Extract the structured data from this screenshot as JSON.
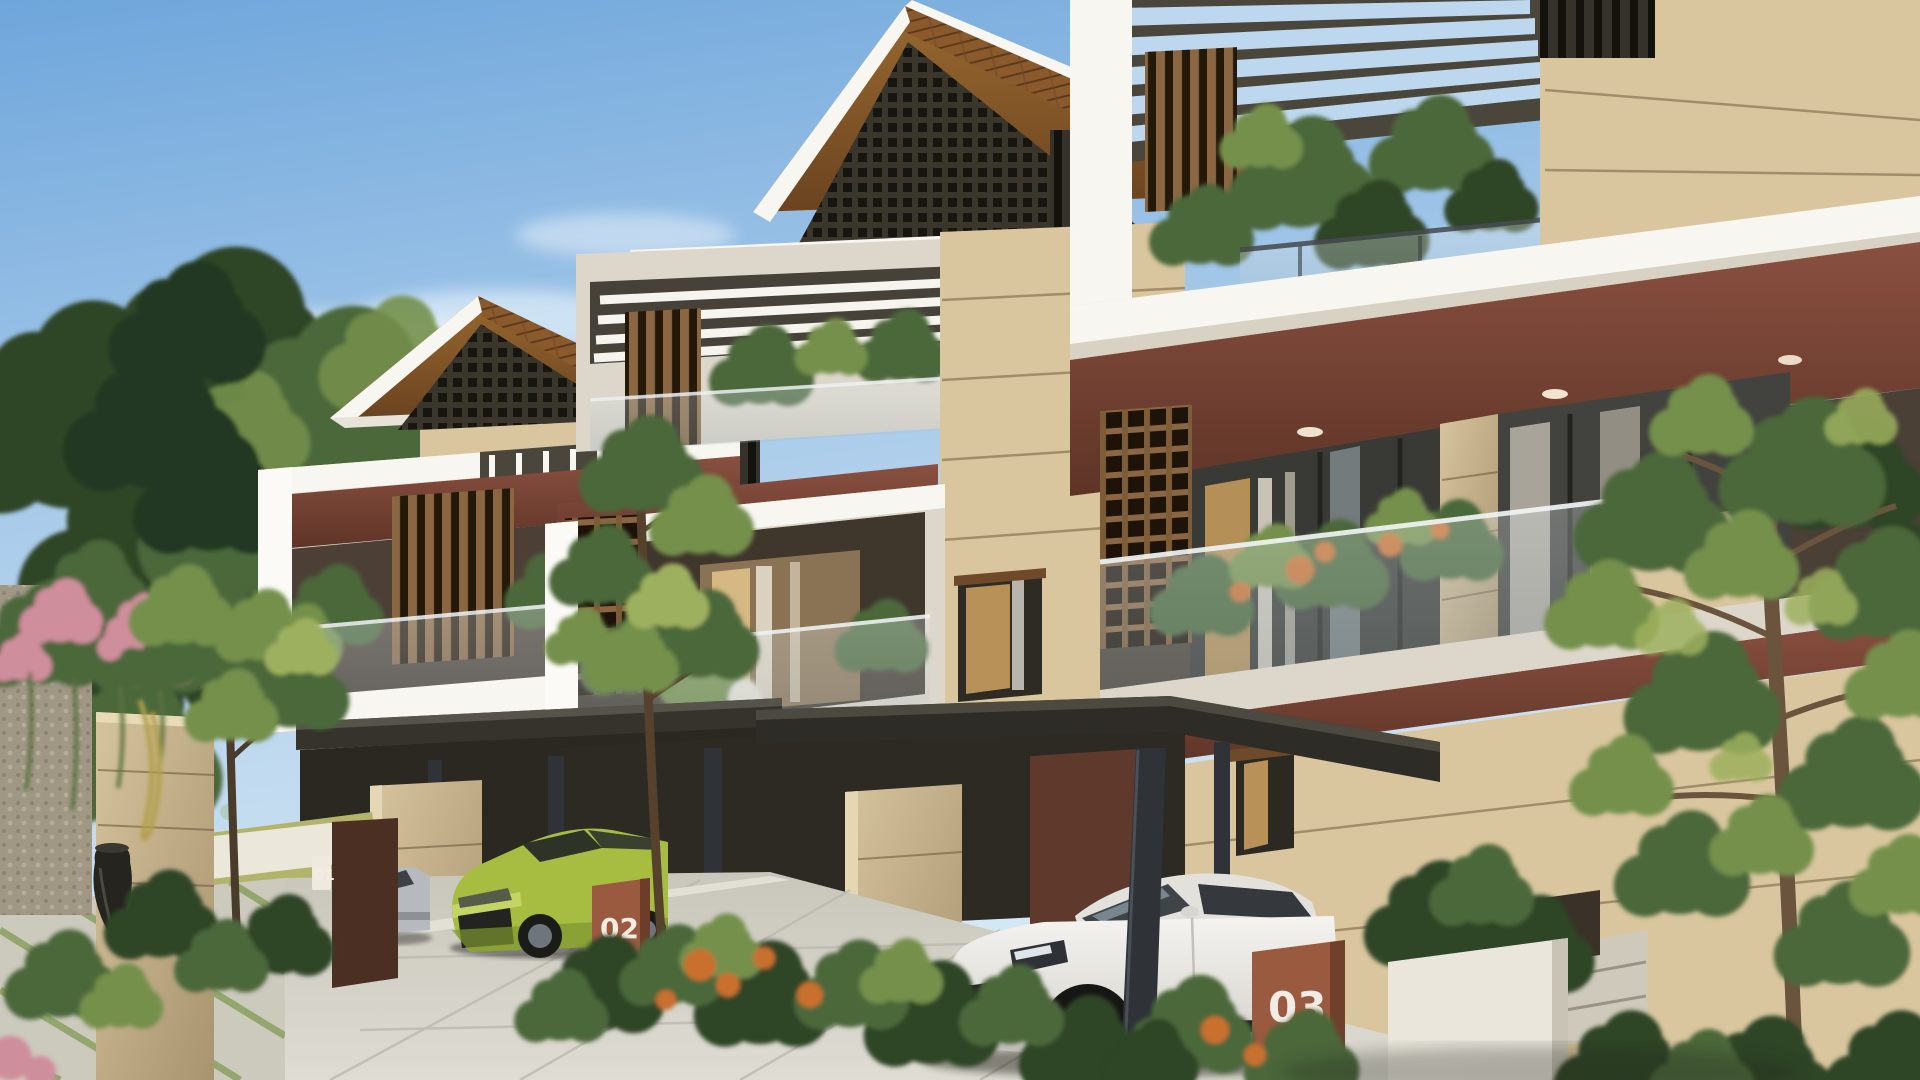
{
  "scene": {
    "markers": {
      "unit01": "01",
      "unit02": "02",
      "unit03": "03"
    }
  },
  "palette": {
    "sky_top": "#74a9dc",
    "sky_low": "#d7e8f5",
    "cloud": "#eff6fc",
    "foliage_dark": "#2e4527",
    "foliage_mid": "#4c683a",
    "foliage_light": "#74904b",
    "foliage_sun": "#9db05e",
    "roof_tile": "#8a5a2c",
    "roof_shadow": "#5e3a1c",
    "gable_dark": "#2a2822",
    "white_lit": "#f8f6f0",
    "white_shade": "#ddd7cb",
    "beige_lit": "#d9c69e",
    "beige_shade": "#b09876",
    "maroon": "#7c4434",
    "maroon_dark": "#5c3226",
    "wood": "#8a6742",
    "wood_dark": "#3a2a1a",
    "glass": "#b9c6cc",
    "warm_light": "#e5bf82",
    "canopy_dark": "#35332c",
    "column_dark": "#2f3338",
    "pave": "#d2cfc5",
    "grass_joint": "#8aa060",
    "terracotta": "#9a5a40",
    "car_white": "#e9e7e2",
    "car_green": "#a6bd41",
    "car_silver": "#b6babe",
    "bougainvillea_pink": "#cf8e9b"
  }
}
